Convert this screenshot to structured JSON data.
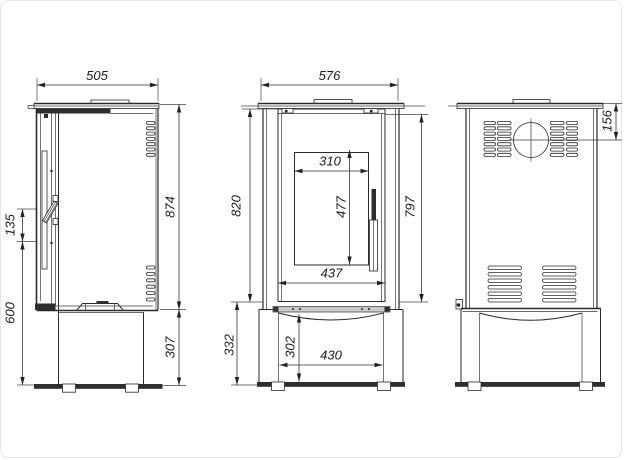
{
  "drawing": {
    "title": "stove-three-view-dimension-drawing",
    "background": "#ffffff",
    "line_color": "#2a2a2a",
    "band_color": "#c9c9c9"
  },
  "views": {
    "side": {
      "dims": {
        "top_width": "505",
        "body_height": "874",
        "base_height": "307",
        "handle_span": "135",
        "handle_height_from_floor": "600"
      }
    },
    "front": {
      "dims": {
        "top_width": "576",
        "door_height_left": "820",
        "door_height_right": "797",
        "glass_width": "310",
        "glass_height": "477",
        "door_width": "437",
        "base_height_left": "332",
        "base_opening_height": "302",
        "base_opening_width": "430"
      }
    },
    "back": {
      "dims": {
        "flue_center_from_top": "156"
      }
    }
  }
}
